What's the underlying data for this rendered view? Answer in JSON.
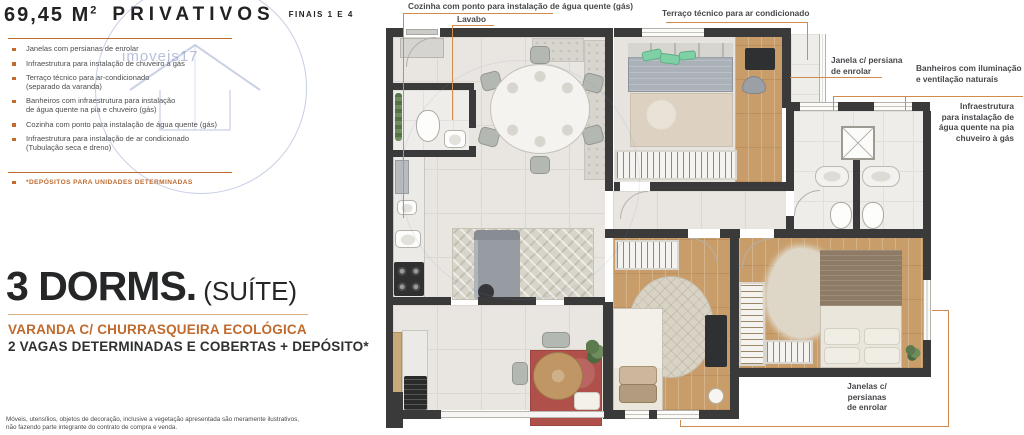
{
  "colors": {
    "accent": "#c06a2e",
    "line": "#d28a4d",
    "wall": "#3a3a3a",
    "wood": "#c89d69",
    "redrug": "#b0504b"
  },
  "left": {
    "area": "69,45 M",
    "area_sup": "2",
    "privativos": "PRIVATIVOS",
    "finais": "FINAIS 1 E 4",
    "features": [
      "Janelas com persianas de enrolar",
      "Infraestrutura para instalação de chuveiro à gás",
      "Terraço técnico para ar-condicionado\n(separado da varanda)",
      "Banheiros com infraestrutura para instalação\nde água quente na pia e chuveiro (gás)",
      "Cozinha com ponto para instalação de água quente (gás)",
      "Infraestrutura para instalação de ar condicionado\n(Tubulação seca e dreno)"
    ],
    "note": "*DEPÓSITOS PARA UNIDADES DETERMINADAS",
    "dorms": "3 DORMS.",
    "dorms_suffix": "(SUÍTE)",
    "highlight1": "VARANDA C/ CHURRASQUEIRA ECOLÓGICA",
    "highlight2": "2 VAGAS DETERMINADAS E COBERTAS + DEPÓSITO*",
    "disclaimer": "Móveis, utensílios, objetos de decoração, inclusive a vegetação apresentada são meramente ilustrativos,\nnão fazendo parte integrante do contrato de compra e venda."
  },
  "callouts": {
    "cozinha": "Cozinha com ponto para instalação de água quente (gás)",
    "lavabo": "Lavabo",
    "terraco": "Terraço técnico para ar condicionado",
    "janela_top": "Janela c/ persiana\nde enrolar",
    "banheiros": "Banheiros com iluminação\ne ventilação naturais",
    "infraestrutura": "Infraestrutura\npara instalação de\nágua quente na pia\nchuveiro à gás",
    "janelas_bottom": "Janelas c/\npersianas\nde enrolar"
  },
  "watermark": "imoveis17"
}
